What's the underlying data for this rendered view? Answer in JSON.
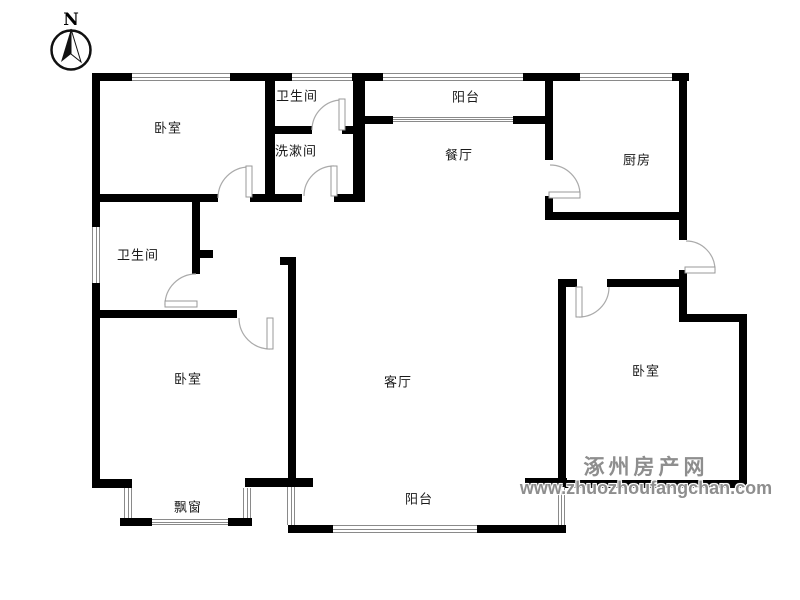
{
  "page": {
    "background": "#ffffff"
  },
  "colors": {
    "wall": "#000000",
    "window_line": "#8a8a8a",
    "door_line": "#aaaaaa",
    "label": "#1a1a1a",
    "watermark": "#8e8e8e"
  },
  "compass": {
    "label": "N"
  },
  "rooms": [
    {
      "id": "bedroom-top-left",
      "label": "卧室"
    },
    {
      "id": "bathroom-top",
      "label": "卫生间"
    },
    {
      "id": "washroom",
      "label": "洗漱间"
    },
    {
      "id": "balcony-top",
      "label": "阳台"
    },
    {
      "id": "dining-room",
      "label": "餐厅"
    },
    {
      "id": "kitchen",
      "label": "厨房"
    },
    {
      "id": "bathroom-left",
      "label": "卫生间"
    },
    {
      "id": "bedroom-bottom-left",
      "label": "卧室"
    },
    {
      "id": "living-room",
      "label": "客厅"
    },
    {
      "id": "bedroom-right",
      "label": "卧室"
    },
    {
      "id": "bay-window",
      "label": "飘窗"
    },
    {
      "id": "balcony-bottom",
      "label": "阳台"
    }
  ],
  "watermark": {
    "site_name": "涿州房产网",
    "site_url": "www.zhuozhoufangchan.com"
  }
}
